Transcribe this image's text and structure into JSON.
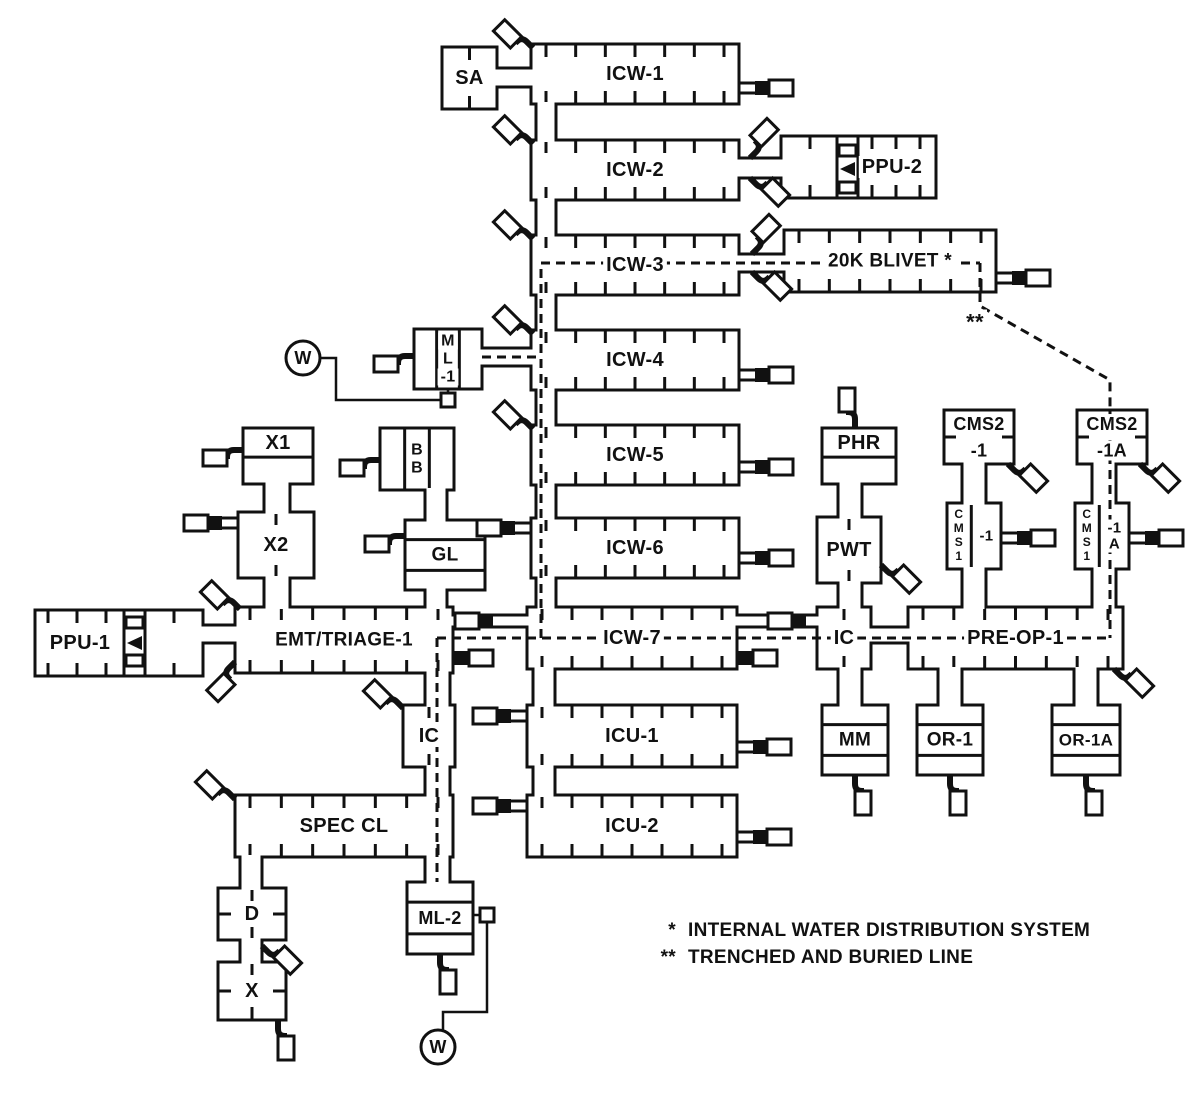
{
  "diagram": {
    "canvas": {
      "width": 1200,
      "height": 1104,
      "background": "#ffffff",
      "line_color": "#111111"
    },
    "nodes": [
      {
        "id": "sa",
        "label": "SA",
        "x": 442,
        "y": 47,
        "w": 55,
        "h": 62,
        "style": "ticks-center"
      },
      {
        "id": "icw1",
        "label": "ICW-1",
        "x": 531,
        "y": 44,
        "w": 208,
        "h": 60,
        "style": "ticks"
      },
      {
        "id": "icw2",
        "label": "ICW-2",
        "x": 531,
        "y": 140,
        "w": 208,
        "h": 60,
        "style": "ticks"
      },
      {
        "id": "ppu2",
        "label": "PPU-2",
        "x": 781,
        "y": 136,
        "w": 155,
        "h": 62,
        "style": "ticks",
        "lx": 892,
        "tick_range": [
          872,
          920
        ],
        "extra_ticks": [
          810
        ]
      },
      {
        "id": "icw3",
        "label": "ICW-3",
        "x": 531,
        "y": 235,
        "w": 208,
        "h": 60,
        "style": "ticks"
      },
      {
        "id": "blivet",
        "label": "20K BLIVET *",
        "x": 784,
        "y": 230,
        "w": 212,
        "h": 62,
        "style": "ticks",
        "fs": 19
      },
      {
        "id": "ml1",
        "label": "M|L|-1",
        "x": 414,
        "y": 329,
        "w": 68,
        "h": 60,
        "style": "vcols"
      },
      {
        "id": "icw4",
        "label": "ICW-4",
        "x": 531,
        "y": 330,
        "w": 208,
        "h": 60,
        "style": "ticks"
      },
      {
        "id": "icw5",
        "label": "ICW-5",
        "x": 531,
        "y": 425,
        "w": 208,
        "h": 60,
        "style": "ticks"
      },
      {
        "id": "bb",
        "label": "B|B",
        "x": 380,
        "y": 428,
        "w": 74,
        "h": 62,
        "style": "vcols"
      },
      {
        "id": "x1",
        "label": "X1",
        "x": 243,
        "y": 428,
        "w": 70,
        "h": 56,
        "style": "rows2"
      },
      {
        "id": "x2",
        "label": "X2",
        "x": 238,
        "y": 512,
        "w": 76,
        "h": 66,
        "style": "ticks-center"
      },
      {
        "id": "gl",
        "label": "GL",
        "x": 405,
        "y": 520,
        "w": 80,
        "h": 70,
        "style": "rows3"
      },
      {
        "id": "icw6",
        "label": "ICW-6",
        "x": 531,
        "y": 518,
        "w": 208,
        "h": 60,
        "style": "ticks"
      },
      {
        "id": "ppu1",
        "label": "PPU-1",
        "x": 35,
        "y": 610,
        "w": 168,
        "h": 66,
        "style": "ticks",
        "lx": 80,
        "tick_range": [
          48,
          106
        ],
        "extra_ticks": [
          174
        ]
      },
      {
        "id": "emt",
        "label": "EMT/TRIAGE-1",
        "x": 235,
        "y": 607,
        "w": 218,
        "h": 66,
        "style": "ticks",
        "fs": 19
      },
      {
        "id": "icw7",
        "label": "ICW-7",
        "x": 527,
        "y": 607,
        "w": 210,
        "h": 62,
        "style": "ticks"
      },
      {
        "id": "icr",
        "label": "IC",
        "x": 817,
        "y": 607,
        "w": 54,
        "h": 62,
        "style": "ticks-center"
      },
      {
        "id": "preop",
        "label": "PRE-OP-1",
        "x": 908,
        "y": 607,
        "w": 215,
        "h": 62,
        "style": "ticks"
      },
      {
        "id": "phr",
        "label": "PHR",
        "x": 822,
        "y": 428,
        "w": 74,
        "h": 56,
        "style": "rows2"
      },
      {
        "id": "pwt",
        "label": "PWT",
        "x": 817,
        "y": 517,
        "w": 64,
        "h": 66,
        "style": "ticks-center"
      },
      {
        "id": "cms2_1",
        "label": "CMS2|-1",
        "x": 944,
        "y": 410,
        "w": 70,
        "h": 54,
        "style": "lines2"
      },
      {
        "id": "cms1_1",
        "label": "-1",
        "left": "CMS1",
        "x": 947,
        "y": 503,
        "w": 54,
        "h": 66,
        "style": "cms"
      },
      {
        "id": "cms2_1a",
        "label": "CMS2|-1A",
        "x": 1077,
        "y": 410,
        "w": 70,
        "h": 54,
        "style": "lines2"
      },
      {
        "id": "cms1_1a",
        "label": "-1|A",
        "left": "CMS1",
        "x": 1075,
        "y": 503,
        "w": 54,
        "h": 66,
        "style": "cms"
      },
      {
        "id": "mm",
        "label": "MM",
        "x": 822,
        "y": 705,
        "w": 66,
        "h": 70,
        "style": "rows3"
      },
      {
        "id": "or1",
        "label": "OR-1",
        "x": 917,
        "y": 705,
        "w": 66,
        "h": 70,
        "style": "rows3"
      },
      {
        "id": "or1a",
        "label": "OR-1A",
        "x": 1052,
        "y": 705,
        "w": 68,
        "h": 70,
        "style": "rows3",
        "fs": 17
      },
      {
        "id": "icu1",
        "label": "ICU-1",
        "x": 527,
        "y": 705,
        "w": 210,
        "h": 62,
        "style": "ticks"
      },
      {
        "id": "icu2",
        "label": "ICU-2",
        "x": 527,
        "y": 795,
        "w": 210,
        "h": 62,
        "style": "ticks"
      },
      {
        "id": "icl",
        "label": "IC",
        "x": 403,
        "y": 705,
        "w": 52,
        "h": 62,
        "style": "ticks-center"
      },
      {
        "id": "speccl",
        "label": "SPEC CL",
        "x": 235,
        "y": 795,
        "w": 218,
        "h": 62,
        "style": "ticks"
      },
      {
        "id": "d",
        "label": "D",
        "x": 218,
        "y": 888,
        "w": 68,
        "h": 52,
        "style": "ticks-side"
      },
      {
        "id": "x",
        "label": "X",
        "x": 218,
        "y": 962,
        "w": 68,
        "h": 58,
        "style": "ticks-side"
      },
      {
        "id": "ml2",
        "label": "ML-2",
        "x": 407,
        "y": 882,
        "w": 66,
        "h": 72,
        "style": "rows3",
        "fs": 18
      }
    ],
    "generators": [
      {
        "id": "ppu1-generator",
        "divs": [
          124,
          145
        ],
        "y1": 610,
        "y2": 676,
        "teeth_x": 126,
        "teeth_w": 17,
        "teeth_h": 11,
        "teeth_ys": [
          617,
          655
        ],
        "tri": "127,643 142,636 142,650"
      },
      {
        "id": "ppu2-generator",
        "divs": [
          837,
          858
        ],
        "y1": 136,
        "y2": 198,
        "teeth_x": 839,
        "teeth_w": 17,
        "teeth_h": 11,
        "teeth_ys": [
          145,
          182
        ],
        "tri": "840,169 855,162 855,176"
      }
    ],
    "ducts": [
      {
        "o": "h",
        "x": 497,
        "y": 68,
        "w": 34,
        "h": 19
      },
      {
        "o": "v",
        "x": 536,
        "y": 104,
        "w": 20,
        "h": 36
      },
      {
        "o": "h",
        "x": 739,
        "y": 158,
        "w": 42,
        "h": 20
      },
      {
        "o": "v",
        "x": 536,
        "y": 200,
        "w": 20,
        "h": 35
      },
      {
        "o": "h",
        "x": 739,
        "y": 254,
        "w": 45,
        "h": 18
      },
      {
        "o": "v",
        "x": 536,
        "y": 295,
        "w": 20,
        "h": 35
      },
      {
        "o": "h",
        "x": 482,
        "y": 348,
        "w": 49,
        "h": 18
      },
      {
        "o": "v",
        "x": 536,
        "y": 390,
        "w": 20,
        "h": 35
      },
      {
        "o": "v",
        "x": 536,
        "y": 485,
        "w": 20,
        "h": 33
      },
      {
        "o": "v",
        "x": 536,
        "y": 578,
        "w": 20,
        "h": 29
      },
      {
        "o": "v",
        "x": 425,
        "y": 490,
        "w": 22,
        "h": 30
      },
      {
        "o": "v",
        "x": 425,
        "y": 590,
        "w": 22,
        "h": 17
      },
      {
        "o": "v",
        "x": 264,
        "y": 484,
        "w": 26,
        "h": 28
      },
      {
        "o": "v",
        "x": 264,
        "y": 578,
        "w": 26,
        "h": 29
      },
      {
        "o": "h",
        "x": 203,
        "y": 625,
        "w": 32,
        "h": 18
      },
      {
        "o": "v",
        "x": 425,
        "y": 673,
        "w": 25,
        "h": 32
      },
      {
        "o": "v",
        "x": 425,
        "y": 767,
        "w": 25,
        "h": 28
      },
      {
        "o": "v",
        "x": 425,
        "y": 857,
        "w": 25,
        "h": 25
      },
      {
        "o": "v",
        "x": 240,
        "y": 857,
        "w": 22,
        "h": 31
      },
      {
        "o": "v",
        "x": 240,
        "y": 940,
        "w": 22,
        "h": 22
      },
      {
        "o": "v",
        "x": 533,
        "y": 669,
        "w": 22,
        "h": 36
      },
      {
        "o": "v",
        "x": 533,
        "y": 767,
        "w": 22,
        "h": 28
      },
      {
        "o": "h",
        "x": 871,
        "y": 627,
        "w": 37,
        "h": 16
      },
      {
        "o": "v",
        "x": 838,
        "y": 484,
        "w": 24,
        "h": 33
      },
      {
        "o": "v",
        "x": 838,
        "y": 583,
        "w": 24,
        "h": 24
      },
      {
        "o": "v",
        "x": 838,
        "y": 669,
        "w": 24,
        "h": 36
      },
      {
        "o": "v",
        "x": 962,
        "y": 464,
        "w": 24,
        "h": 39
      },
      {
        "o": "v",
        "x": 962,
        "y": 569,
        "w": 24,
        "h": 38
      },
      {
        "o": "v",
        "x": 938,
        "y": 669,
        "w": 24,
        "h": 36
      },
      {
        "o": "v",
        "x": 1092,
        "y": 464,
        "w": 24,
        "h": 39
      },
      {
        "o": "v",
        "x": 1092,
        "y": 569,
        "w": 24,
        "h": 38
      },
      {
        "o": "v",
        "x": 1074,
        "y": 669,
        "w": 24,
        "h": 36
      }
    ],
    "through_connectors": [
      {
        "x1": 453,
        "x2": 527,
        "y": 621,
        "rx": 455
      },
      {
        "x1": 737,
        "x2": 817,
        "y": 621,
        "rx": 768
      }
    ],
    "dashed_lines": [
      {
        "name": "main-riser-and-top-run",
        "points": "541,638 541,263 980,263"
      },
      {
        "name": "trenched-buried-line",
        "points": "980,263 980,306 1110,380 1110,410"
      },
      {
        "name": "ml1-branch",
        "points": "482,357 541,357"
      },
      {
        "name": "lower-main-run",
        "points": "437,638 1110,638"
      },
      {
        "name": "left-drop",
        "points": "437,638 437,882"
      },
      {
        "name": "right-riser",
        "points": "1110,410 1110,638"
      }
    ],
    "spigots": [
      {
        "x": 739,
        "y": 88,
        "rot": 0,
        "t": "A"
      },
      {
        "x": 996,
        "y": 278,
        "rot": 0,
        "t": "A"
      },
      {
        "x": 739,
        "y": 375,
        "rot": 0,
        "t": "A"
      },
      {
        "x": 739,
        "y": 467,
        "rot": 0,
        "t": "A"
      },
      {
        "x": 531,
        "y": 528,
        "rot": 180,
        "t": "A"
      },
      {
        "x": 739,
        "y": 558,
        "rot": 0,
        "t": "A"
      },
      {
        "x": 238,
        "y": 523,
        "rot": 180,
        "t": "A"
      },
      {
        "x": 1001,
        "y": 538,
        "rot": 0,
        "t": "A"
      },
      {
        "x": 1129,
        "y": 538,
        "rot": 0,
        "t": "A"
      },
      {
        "x": 527,
        "y": 716,
        "rot": 180,
        "t": "A"
      },
      {
        "x": 737,
        "y": 747,
        "rot": 0,
        "t": "A"
      },
      {
        "x": 527,
        "y": 806,
        "rot": 180,
        "t": "A"
      },
      {
        "x": 737,
        "y": 837,
        "rot": 0,
        "t": "A"
      },
      {
        "x": 453,
        "y": 658,
        "rot": 0,
        "t": "B"
      },
      {
        "x": 737,
        "y": 658,
        "rot": 0,
        "t": "B"
      }
    ],
    "faucets": [
      {
        "x": 533,
        "y": 48,
        "rot": -135
      },
      {
        "x": 533,
        "y": 144,
        "rot": -135
      },
      {
        "x": 750,
        "y": 158,
        "rot": -45
      },
      {
        "x": 750,
        "y": 178,
        "rot": 45
      },
      {
        "x": 533,
        "y": 239,
        "rot": -135
      },
      {
        "x": 752,
        "y": 254,
        "rot": -45
      },
      {
        "x": 752,
        "y": 272,
        "rot": 45
      },
      {
        "x": 533,
        "y": 334,
        "rot": -135
      },
      {
        "x": 414,
        "y": 356,
        "rot": 180
      },
      {
        "x": 533,
        "y": 429,
        "rot": -135
      },
      {
        "x": 380,
        "y": 460,
        "rot": 180
      },
      {
        "x": 243,
        "y": 450,
        "rot": 180
      },
      {
        "x": 405,
        "y": 536,
        "rot": 180
      },
      {
        "x": 240,
        "y": 609,
        "rot": -135
      },
      {
        "x": 235,
        "y": 662,
        "rot": 135
      },
      {
        "x": 855,
        "y": 428,
        "rot": -90
      },
      {
        "x": 881,
        "y": 565,
        "rot": 45
      },
      {
        "x": 1008,
        "y": 464,
        "rot": 45
      },
      {
        "x": 1140,
        "y": 464,
        "rot": 45
      },
      {
        "x": 403,
        "y": 708,
        "rot": -135
      },
      {
        "x": 1114,
        "y": 669,
        "rot": 45
      },
      {
        "x": 235,
        "y": 799,
        "rot": -135
      },
      {
        "x": 262,
        "y": 946,
        "rot": 45
      },
      {
        "x": 855,
        "y": 775,
        "rot": 90
      },
      {
        "x": 950,
        "y": 775,
        "rot": 90
      },
      {
        "x": 1086,
        "y": 775,
        "rot": 90
      },
      {
        "x": 440,
        "y": 954,
        "rot": 90
      },
      {
        "x": 278,
        "y": 1020,
        "rot": 90
      }
    ],
    "squares": [
      {
        "x": 441,
        "y": 393,
        "s": 14
      },
      {
        "x": 480,
        "y": 908,
        "s": 14
      }
    ],
    "wires": [
      {
        "points": "320,358 336,358 336,400 441,400"
      },
      {
        "points": "448,389 448,394"
      },
      {
        "points": "473,915 480,915"
      },
      {
        "points": "487,922 487,1012 443,1012 443,1031"
      }
    ],
    "w_markers": [
      {
        "label": "W",
        "cx": 303,
        "cy": 358,
        "r": 17
      },
      {
        "label": "W",
        "cx": 438,
        "cy": 1047,
        "r": 17
      }
    ],
    "annotation": {
      "text": "**",
      "x": 975,
      "y": 322
    },
    "legend": {
      "x": 640,
      "y": 920,
      "items": [
        {
          "symbol": "*",
          "text": "INTERNAL WATER DISTRIBUTION SYSTEM"
        },
        {
          "symbol": "**",
          "text": "TRENCHED AND BURIED LINE"
        }
      ]
    }
  }
}
